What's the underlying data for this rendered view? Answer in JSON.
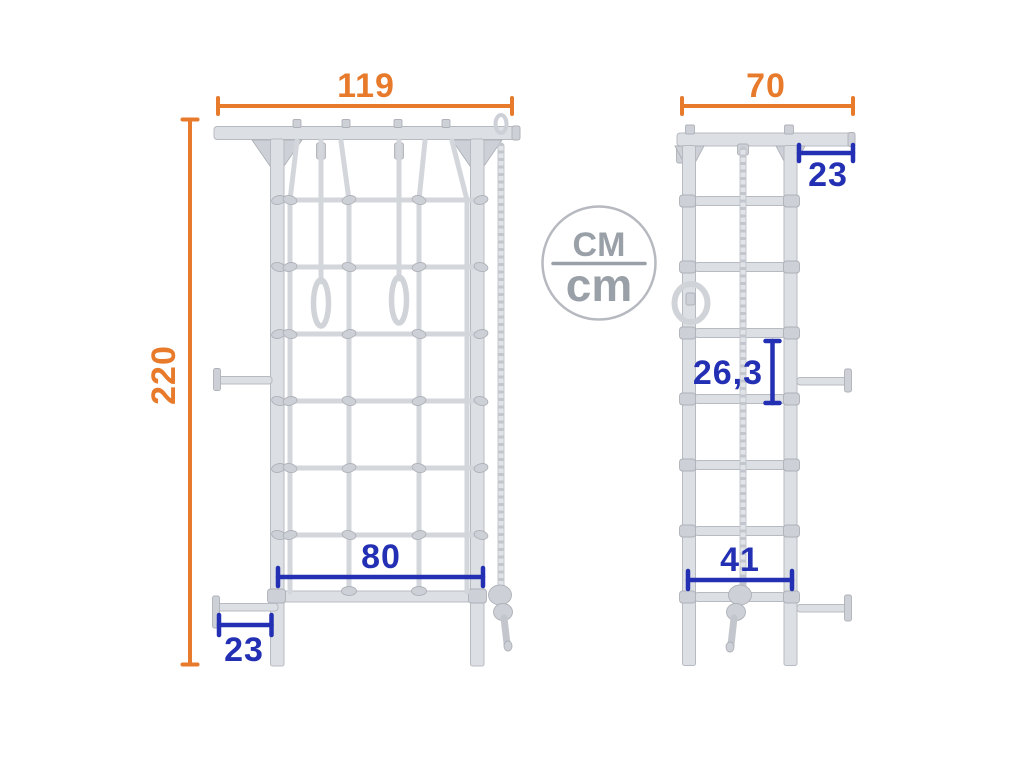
{
  "diagram": {
    "unit_badge": {
      "numerator": "CM",
      "denominator": "cm"
    },
    "front_view": {
      "width": "119",
      "height": "220",
      "inner_width": "80",
      "bracket_offset": "23"
    },
    "side_view": {
      "depth": "70",
      "wall_offset": "23",
      "rung_spacing": "26,3",
      "inner_depth": "41"
    },
    "colors": {
      "dimension_orange": "#e87a2b",
      "dimension_blue": "#2430b3",
      "frame_gray": "#dcdfe3",
      "badge_gray": "#9aa0a7"
    }
  }
}
